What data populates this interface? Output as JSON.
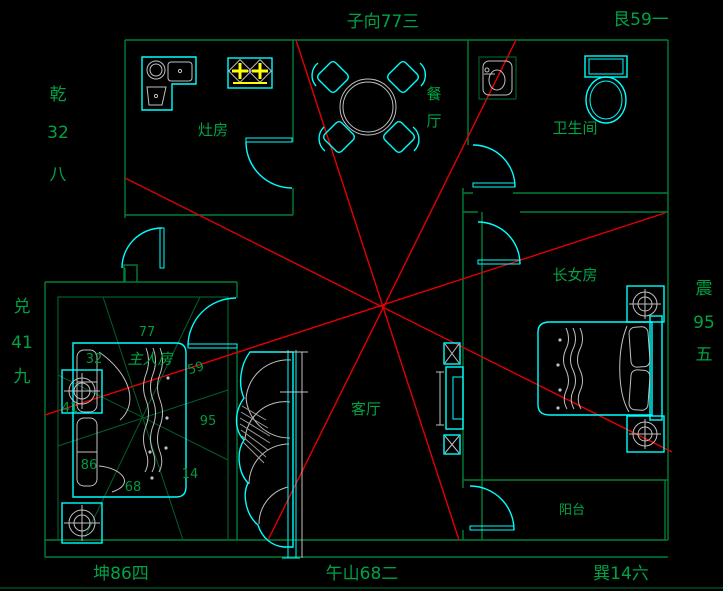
{
  "colors": {
    "background": "#000000",
    "walls_green": "#008038",
    "analysis_red": "#e30000",
    "fixtures_cyan": "#00ffff",
    "furniture_gray": "#c0c0c0",
    "burner_yellow": "#ffff00",
    "label_green": "#00a344"
  },
  "compass": {
    "top": "子向77三",
    "top_right": "艮59一",
    "left_top": [
      "乾",
      "32",
      "八"
    ],
    "left_mid": [
      "兑",
      "41",
      "九"
    ],
    "right": [
      "震",
      "95",
      "五"
    ],
    "bottom_left": "坤86四",
    "bottom_center": "午山68二",
    "bottom_right": "巽14六"
  },
  "rooms": {
    "kitchen": "灶房",
    "dining": [
      "餐",
      "厅"
    ],
    "bathroom": "卫生间",
    "eldest_daughter": "长女房",
    "master": "主人房",
    "living": "客厅",
    "balcony": "阳台"
  },
  "master_star_numbers": {
    "top": "77",
    "upper_left": "32",
    "upper_right": "59",
    "left": "41",
    "right": "95",
    "lower_left": "86",
    "bottom": "68",
    "lower_right": "14"
  }
}
